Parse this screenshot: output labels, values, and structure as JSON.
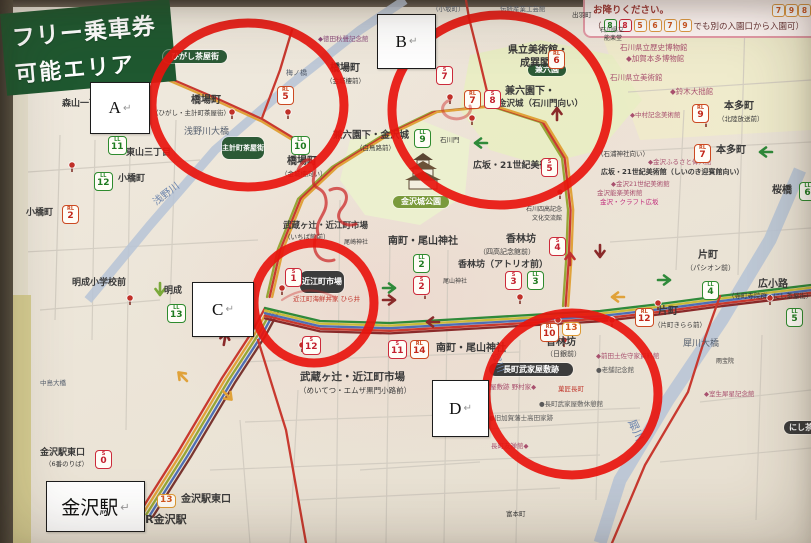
{
  "colors": {
    "circle": "#e8150e",
    "banner_bg": "#1f5830",
    "banner_text": "#ffffff",
    "legend_border": "#e39aa6",
    "rl": "#cc4a22",
    "ll": "#2e8b2e",
    "s": "#cc2a3a",
    "o": "#dd9933",
    "river": "#b9c5d6",
    "park": "#e9edc4",
    "pill_green": "#2c5a36",
    "pill_dark": "#3c3c3c"
  },
  "banner": {
    "line1": "フリー乗車券",
    "line2": "可能エリア"
  },
  "legend": {
    "line1": "お降りください。",
    "line1_badges": [
      {
        "n": "7",
        "st": "o"
      },
      {
        "n": "9",
        "st": "o"
      },
      {
        "n": "8",
        "st": "o"
      }
    ],
    "line2_prefix": "（",
    "line2_badges": [
      {
        "n": "8",
        "st": "ll"
      },
      {
        "n": "8",
        "st": "s"
      },
      {
        "n": "5",
        "st": "o"
      },
      {
        "n": "6",
        "st": "o"
      },
      {
        "n": "7",
        "st": "o"
      },
      {
        "n": "9",
        "st": "o"
      }
    ],
    "line2_suffix": "でも別の入園口から入園可）"
  },
  "annotations": {
    "boxes": [
      {
        "name": "annotation-a",
        "label": "A",
        "mark": "↵",
        "x": 90,
        "y": 82,
        "w": 58,
        "h": 50,
        "fs": 17
      },
      {
        "name": "annotation-b",
        "label": "B",
        "mark": "↵",
        "x": 377,
        "y": 14,
        "w": 57,
        "h": 53,
        "fs": 17
      },
      {
        "name": "annotation-c",
        "label": "C",
        "mark": "↵",
        "x": 192,
        "y": 282,
        "w": 60,
        "h": 53,
        "fs": 17
      },
      {
        "name": "annotation-d",
        "label": "D",
        "mark": "↵",
        "x": 432,
        "y": 380,
        "w": 55,
        "h": 55,
        "fs": 17
      },
      {
        "name": "annotation-kanazawa-station",
        "label": "金沢駅",
        "mark": "↵",
        "x": 46,
        "y": 481,
        "w": 97,
        "h": 49,
        "fs": 19
      }
    ]
  },
  "map": {
    "circles": [
      {
        "id": "A",
        "cx": 248,
        "cy": 105,
        "rx": 96,
        "ry": 82
      },
      {
        "id": "B",
        "cx": 500,
        "cy": 110,
        "rx": 108,
        "ry": 95
      },
      {
        "id": "C",
        "cx": 314,
        "cy": 303,
        "rx": 60,
        "ry": 60
      },
      {
        "id": "D",
        "cx": 572,
        "cy": 394,
        "rx": 86,
        "ry": 81
      }
    ],
    "pills": [
      {
        "t": "ひがし茶屋街",
        "x": 163,
        "y": 50,
        "w": 64,
        "h": 13,
        "bg": "#2c5a36",
        "fs": 8
      },
      {
        "t": "主計町茶屋街",
        "x": 222,
        "y": 137,
        "w": 42,
        "h": 22,
        "bg": "#2c5a36",
        "fs": 7
      },
      {
        "t": "兼六園",
        "x": 528,
        "y": 64,
        "w": 38,
        "h": 12,
        "bg": "#2c5a36",
        "fs": 8
      },
      {
        "t": "金沢城公園",
        "x": 393,
        "y": 196,
        "w": 56,
        "h": 12,
        "bg": "#7a9a3c",
        "fs": 8
      },
      {
        "t": "近江町市場",
        "x": 300,
        "y": 271,
        "w": 44,
        "h": 22,
        "bg": "#3c3c3c",
        "fs": 8
      },
      {
        "t": "長町武家屋敷跡",
        "x": 489,
        "y": 363,
        "w": 84,
        "h": 13,
        "bg": "#3c3c3c",
        "fs": 8
      },
      {
        "t": "にし茶屋街",
        "x": 784,
        "y": 421,
        "w": 50,
        "h": 13,
        "bg": "#3c3c3c",
        "fs": 8
      }
    ],
    "badges": [
      {
        "x": 108,
        "y": 136,
        "p": "LL",
        "n": "11",
        "st": "ll"
      },
      {
        "x": 94,
        "y": 172,
        "p": "LL",
        "n": "12",
        "st": "ll"
      },
      {
        "x": 62,
        "y": 205,
        "p": "RL",
        "n": "2",
        "st": "rl"
      },
      {
        "x": 167,
        "y": 304,
        "p": "LL",
        "n": "13",
        "st": "ll"
      },
      {
        "x": 277,
        "y": 86,
        "p": "RL",
        "n": "5",
        "st": "rl"
      },
      {
        "x": 291,
        "y": 136,
        "p": "LL",
        "n": "10",
        "st": "ll"
      },
      {
        "x": 548,
        "y": 50,
        "p": "RL",
        "n": "6",
        "st": "rl"
      },
      {
        "x": 436,
        "y": 66,
        "p": "S",
        "n": "7",
        "st": "s"
      },
      {
        "x": 464,
        "y": 90,
        "p": "RL",
        "n": "7",
        "st": "rl"
      },
      {
        "x": 484,
        "y": 90,
        "p": "S",
        "n": "8",
        "st": "s"
      },
      {
        "x": 414,
        "y": 129,
        "p": "LL",
        "n": "9",
        "st": "ll"
      },
      {
        "x": 541,
        "y": 158,
        "p": "S",
        "n": "5",
        "st": "s"
      },
      {
        "x": 285,
        "y": 268,
        "p": "S",
        "n": "1",
        "st": "s"
      },
      {
        "x": 302,
        "y": 336,
        "p": "S",
        "n": "12",
        "st": "s"
      },
      {
        "x": 413,
        "y": 254,
        "p": "LL",
        "n": "2",
        "st": "ll"
      },
      {
        "x": 413,
        "y": 276,
        "p": "S",
        "n": "2",
        "st": "s"
      },
      {
        "x": 505,
        "y": 271,
        "p": "S",
        "n": "3",
        "st": "s"
      },
      {
        "x": 527,
        "y": 271,
        "p": "LL",
        "n": "3",
        "st": "ll"
      },
      {
        "x": 549,
        "y": 237,
        "p": "S",
        "n": "4",
        "st": "s"
      },
      {
        "x": 388,
        "y": 340,
        "p": "S",
        "n": "11",
        "st": "s"
      },
      {
        "x": 410,
        "y": 340,
        "p": "RL",
        "n": "14",
        "st": "rl"
      },
      {
        "x": 540,
        "y": 323,
        "p": "RL",
        "n": "10",
        "st": "rl"
      },
      {
        "x": 562,
        "y": 322,
        "p": "",
        "n": "13",
        "st": "o"
      },
      {
        "x": 692,
        "y": 104,
        "p": "RL",
        "n": "9",
        "st": "rl"
      },
      {
        "x": 694,
        "y": 144,
        "p": "RL",
        "n": "7",
        "st": "rl"
      },
      {
        "x": 702,
        "y": 281,
        "p": "LL",
        "n": "4",
        "st": "ll"
      },
      {
        "x": 786,
        "y": 308,
        "p": "LL",
        "n": "5",
        "st": "ll"
      },
      {
        "x": 635,
        "y": 308,
        "p": "RL",
        "n": "12",
        "st": "rl"
      },
      {
        "x": 799,
        "y": 182,
        "p": "LL",
        "n": "6",
        "st": "ll"
      },
      {
        "x": 95,
        "y": 450,
        "p": "S",
        "n": "0",
        "st": "s"
      },
      {
        "x": 157,
        "y": 494,
        "p": "",
        "n": "13",
        "st": "o"
      }
    ],
    "labels": [
      {
        "t": "森山一丁目",
        "x": 62,
        "y": 100,
        "s": 9,
        "b": 1
      },
      {
        "t": "東山三丁目",
        "x": 126,
        "y": 149,
        "s": 9,
        "b": 1
      },
      {
        "t": "小橋町",
        "x": 118,
        "y": 175,
        "s": 9,
        "b": 1
      },
      {
        "t": "小橋町",
        "x": 26,
        "y": 209,
        "s": 9,
        "b": 1
      },
      {
        "t": "明成小学校前",
        "x": 72,
        "y": 279,
        "s": 9,
        "b": 1
      },
      {
        "t": "明成",
        "x": 164,
        "y": 287,
        "s": 9,
        "b": 1
      },
      {
        "t": "浅野川",
        "x": 152,
        "y": 200,
        "s": 10,
        "c": "#6b84ad",
        "r": -38
      },
      {
        "t": "浅野川大橋",
        "x": 184,
        "y": 128,
        "s": 9,
        "c": "#555f6e"
      },
      {
        "t": "橋場町",
        "x": 191,
        "y": 96,
        "s": 10,
        "b": 1
      },
      {
        "t": "（ひがし・主計町茶屋街）",
        "x": 152,
        "y": 110,
        "s": 6.5
      },
      {
        "t": "梅ノ橋",
        "x": 286,
        "y": 70,
        "s": 7,
        "c": "#555f6e"
      },
      {
        "t": "橋場町",
        "x": 330,
        "y": 64,
        "s": 10,
        "b": 1
      },
      {
        "t": "（金城樓前）",
        "x": 326,
        "y": 78,
        "s": 6.5
      },
      {
        "t": "◆徳田秋聲記念館",
        "x": 318,
        "y": 36,
        "s": 6.5,
        "c": "#8a4a7a"
      },
      {
        "t": "橋場町",
        "x": 287,
        "y": 157,
        "s": 10,
        "b": 1
      },
      {
        "t": "（金城樓向い）",
        "x": 281,
        "y": 171,
        "s": 6.5
      },
      {
        "t": "兼六園下・金沢城",
        "x": 333,
        "y": 131,
        "s": 9.5,
        "b": 1
      },
      {
        "t": "（白鳥路前）",
        "x": 356,
        "y": 145,
        "s": 6.5
      },
      {
        "t": "石川門",
        "x": 440,
        "y": 137,
        "s": 6.5
      },
      {
        "t": "兼六園",
        "x": 383,
        "y": 40,
        "s": 11,
        "b": 1
      },
      {
        "t": "県立美術館・",
        "x": 508,
        "y": 46,
        "s": 10,
        "b": 1
      },
      {
        "t": "成巽閣",
        "x": 520,
        "y": 59,
        "s": 10,
        "b": 1
      },
      {
        "t": "兼六園下・",
        "x": 505,
        "y": 87,
        "s": 10,
        "b": 1
      },
      {
        "t": "金沢城（石川門向い）",
        "x": 498,
        "y": 100,
        "s": 8.5,
        "b": 1
      },
      {
        "t": "広坂・21世紀美術館",
        "x": 473,
        "y": 162,
        "s": 9,
        "b": 1
      },
      {
        "t": "（石浦神社向い）",
        "x": 597,
        "y": 151,
        "s": 6.5
      },
      {
        "t": "◆金沢ふるさと偉人館",
        "x": 648,
        "y": 159,
        "s": 6.5,
        "c": "#a8506e"
      },
      {
        "t": "広坂・21世紀美術館（しいのき迎賓館向い）",
        "x": 601,
        "y": 169,
        "s": 7,
        "b": 1
      },
      {
        "t": "◆金沢21世紀美術館",
        "x": 611,
        "y": 181,
        "s": 6.5,
        "c": "#a8506e"
      },
      {
        "t": "金沢能楽美術館",
        "x": 597,
        "y": 190,
        "s": 6.5,
        "c": "#a8506e"
      },
      {
        "t": "金沢・クラフト広坂",
        "x": 600,
        "y": 199,
        "s": 6.5,
        "c": "#c2307e"
      },
      {
        "t": "石川県立歴史博物館",
        "x": 620,
        "y": 44,
        "s": 7.5,
        "c": "#a8506e"
      },
      {
        "t": "◆加賀本多博物館",
        "x": 626,
        "y": 55,
        "s": 7.5,
        "c": "#a8506e"
      },
      {
        "t": "石川県立美術館",
        "x": 610,
        "y": 74,
        "s": 7.5,
        "c": "#a8506e"
      },
      {
        "t": "◆鈴木大拙館",
        "x": 670,
        "y": 88,
        "s": 7.5,
        "c": "#a8506e"
      },
      {
        "t": "◆中村記念美術館",
        "x": 630,
        "y": 112,
        "s": 6.5,
        "c": "#a8506e"
      },
      {
        "t": "本多町",
        "x": 724,
        "y": 102,
        "s": 10,
        "b": 1
      },
      {
        "t": "（北陸放送前）",
        "x": 718,
        "y": 116,
        "s": 6.5
      },
      {
        "t": "本多町",
        "x": 716,
        "y": 146,
        "s": 10,
        "b": 1
      },
      {
        "t": "桜橋",
        "x": 772,
        "y": 186,
        "s": 10,
        "b": 1
      },
      {
        "t": "石川四高記念",
        "x": 526,
        "y": 207,
        "s": 6
      },
      {
        "t": "文化交流館",
        "x": 532,
        "y": 216,
        "s": 6
      },
      {
        "t": "南町・尾山神社",
        "x": 388,
        "y": 237,
        "s": 10,
        "b": 1
      },
      {
        "t": "尾山神社",
        "x": 443,
        "y": 279,
        "s": 6
      },
      {
        "t": "尾崎神社",
        "x": 344,
        "y": 240,
        "s": 6
      },
      {
        "t": "香林坊",
        "x": 506,
        "y": 235,
        "s": 10,
        "b": 1
      },
      {
        "t": "（四高記念館前）",
        "x": 479,
        "y": 249,
        "s": 7
      },
      {
        "t": "香林坊（アトリオ前）",
        "x": 458,
        "y": 261,
        "s": 9,
        "b": 1
      },
      {
        "t": "武蔵ヶ辻・近江町市場",
        "x": 283,
        "y": 222,
        "s": 8.5,
        "b": 1
      },
      {
        "t": "（いちば館前）",
        "x": 284,
        "y": 234,
        "s": 6.5
      },
      {
        "t": "近江町海鮮丼家 ひら井",
        "x": 293,
        "y": 296,
        "s": 6.5,
        "c": "#c23a30"
      },
      {
        "t": "武蔵ヶ辻・近江町市場",
        "x": 300,
        "y": 372,
        "s": 10.5,
        "b": 1
      },
      {
        "t": "（めいてつ・エムザ黒門小路前）",
        "x": 299,
        "y": 387,
        "s": 7.5
      },
      {
        "t": "南町・尾山神社",
        "x": 436,
        "y": 344,
        "s": 10,
        "b": 1
      },
      {
        "t": "香林坊",
        "x": 546,
        "y": 338,
        "s": 10,
        "b": 1
      },
      {
        "t": "（日銀前）",
        "x": 546,
        "y": 351,
        "s": 7
      },
      {
        "t": "◆前田土佐守家資料館",
        "x": 596,
        "y": 353,
        "s": 6.5,
        "c": "#a8506e"
      },
      {
        "t": "●老舗記念館",
        "x": 596,
        "y": 367,
        "s": 6.5,
        "c": "#5a5a5a"
      },
      {
        "t": "武家屋敷跡 野村家◆",
        "x": 477,
        "y": 384,
        "s": 6.5,
        "c": "#a8506e"
      },
      {
        "t": "菓匠長町",
        "x": 558,
        "y": 386,
        "s": 6.5,
        "c": "#c23a30"
      },
      {
        "t": "●長町武家屋敷休憩館",
        "x": 539,
        "y": 401,
        "s": 6.5,
        "c": "#5a5a5a"
      },
      {
        "t": "●旧加賀藩士高田家跡",
        "x": 489,
        "y": 415,
        "s": 6.5,
        "c": "#5a5a5a"
      },
      {
        "t": "長町友禅館◆",
        "x": 491,
        "y": 443,
        "s": 6.5,
        "c": "#a8506e"
      },
      {
        "t": "犀川大橋",
        "x": 683,
        "y": 340,
        "s": 9,
        "c": "#555f6e"
      },
      {
        "t": "雨宝院",
        "x": 716,
        "y": 359,
        "s": 6
      },
      {
        "t": "◆室生犀星記念館",
        "x": 704,
        "y": 391,
        "s": 6.5,
        "c": "#a8506e"
      },
      {
        "t": "犀川",
        "x": 636,
        "y": 418,
        "s": 11,
        "c": "#6b84ad",
        "r": 65
      },
      {
        "t": "犀川",
        "x": 498,
        "y": 352,
        "s": 10,
        "c": "#6b84ad",
        "r": 70
      },
      {
        "t": "金沢駅東口",
        "x": 40,
        "y": 449,
        "s": 9,
        "b": 1
      },
      {
        "t": "（6番のりば）",
        "x": 45,
        "y": 461,
        "s": 6.5
      },
      {
        "t": "金沢駅東口",
        "x": 181,
        "y": 495,
        "s": 10,
        "b": 1
      },
      {
        "t": "JR金沢駅",
        "x": 141,
        "y": 514,
        "s": 11,
        "b": 1
      },
      {
        "t": "中島大橋",
        "x": 40,
        "y": 380,
        "s": 6.5,
        "c": "#555f6e"
      },
      {
        "t": "富本町",
        "x": 506,
        "y": 511,
        "s": 6.5
      },
      {
        "t": "出羽町",
        "x": 572,
        "y": 12,
        "s": 6.5
      },
      {
        "t": "石川県立",
        "x": 600,
        "y": 28,
        "s": 6
      },
      {
        "t": "能楽堂",
        "x": 604,
        "y": 36,
        "s": 6
      },
      {
        "t": "片町",
        "x": 698,
        "y": 251,
        "s": 10,
        "b": 1
      },
      {
        "t": "（パシオン前）",
        "x": 686,
        "y": 265,
        "s": 7
      },
      {
        "t": "広小路",
        "x": 758,
        "y": 280,
        "s": 10,
        "b": 1
      },
      {
        "t": "（寺町寺院群・にし茶屋街）",
        "x": 728,
        "y": 293,
        "s": 6.5
      },
      {
        "t": "片町",
        "x": 658,
        "y": 307,
        "s": 10,
        "b": 1
      },
      {
        "t": "（片町きらら前）",
        "x": 654,
        "y": 322,
        "s": 6.5
      },
      {
        "t": "伝統産業工芸館",
        "x": 500,
        "y": 6,
        "s": 6.5,
        "c": "#555f6e"
      },
      {
        "t": "（小坂町）",
        "x": 432,
        "y": 6,
        "s": 6.5,
        "c": "#555f6e"
      }
    ]
  }
}
